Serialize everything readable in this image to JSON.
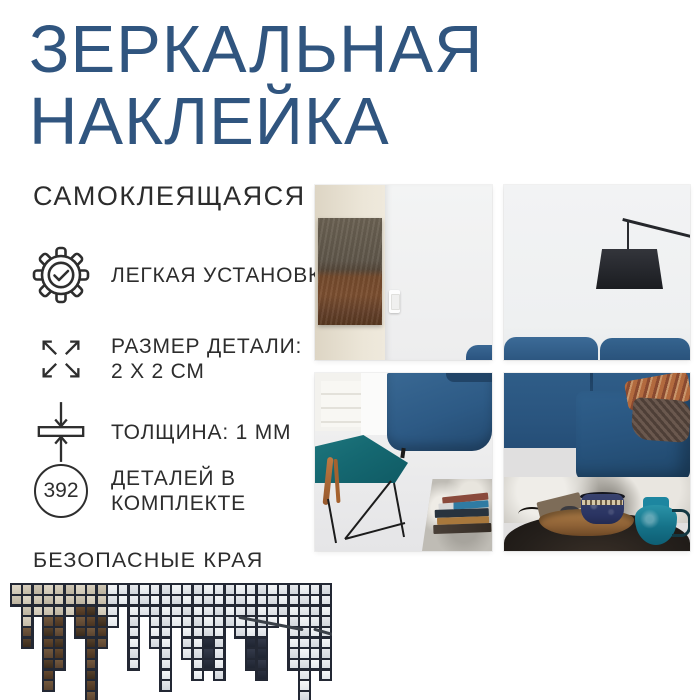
{
  "title": {
    "line1": "ЗЕРКАЛЬНАЯ",
    "line2": "НАКЛЕЙКА",
    "full": "ЗЕРКАЛЬНАЯ\nНАКЛЕЙКА",
    "color": "#30557f"
  },
  "subtitle": "САМОКЛЕЯЩАЯСЯ",
  "features": [
    {
      "icon": "gear-check-icon",
      "label": "ЛЕГКАЯ УСТАНОВКА"
    },
    {
      "icon": "expand-arrows-icon",
      "label": "РАЗМЕР ДЕТАЛИ:\n2 Х 2 СМ"
    },
    {
      "icon": "thickness-icon",
      "label": "ТОЛЩИНА: 1 ММ"
    },
    {
      "icon": "count-badge",
      "badge": "392",
      "label": "ДЕТАЛЕЙ В\nКОМПЛЕКТЕ"
    }
  ],
  "safe_edges_label": "БЕЗОПАСНЫЕ КРАЯ",
  "colors": {
    "background": "#ffffff",
    "title_blue": "#30557f",
    "text_dark": "#2d2d2d",
    "icon_stroke": "#2e2e2e",
    "sofa_blue": "#2e5b86",
    "footstool_teal": "#156871",
    "pitcher_teal": "#157288",
    "artwork_rust": "#744a2c",
    "lamp_black": "#26282e",
    "rug_gray": "#bfbcb5",
    "mosaic_grout": "#232834"
  },
  "mosaic": {
    "pitch": 10.67,
    "grout_w": 2.2,
    "grout": "#232834",
    "palettes": {
      "B": [
        [
          "#ded7c7",
          "#cfc7b5"
        ],
        [
          "#d6cebd",
          "#c6bda9"
        ],
        [
          "#cdc5b4",
          "#bdb4a0"
        ]
      ],
      "L": [
        [
          "#f4f6f8",
          "#e4e8ec"
        ],
        [
          "#eceff2",
          "#dce0e5"
        ],
        [
          "#e4e7eb",
          "#d2d7dd"
        ]
      ],
      "R": [
        [
          "#73593e",
          "#5b4430"
        ],
        [
          "#64492f",
          "#4a3421"
        ],
        [
          "#55402b",
          "#3a2b1c"
        ]
      ],
      "D": [
        [
          "#343a4a",
          "#262c3a"
        ],
        [
          "#2b3140",
          "#1f2532"
        ]
      ]
    },
    "columns": [
      "BB",
      "BBBBRR",
      "BBB",
      "BBBRRRRRRR",
      "BBBRRRRR",
      "BBB",
      "BBRRR",
      "BBRRRRRRRRR",
      "BBBRRR",
      "LLLL",
      "LL",
      "LLLLLLLL",
      "LLL",
      "LLLLLL",
      "LLLLLLLLLL",
      "LLLL",
      "LLLLLLL",
      "LLLLLLLLL",
      "LLLLLDDD",
      "LLLLLLLLL",
      "LLLL",
      "LLLLL",
      "LLLLLDDD",
      "LLLLLDDDD",
      "LLLL",
      "LLL",
      "LLLLLLLL",
      "LLLLLLLLLLL",
      "LLLLLLLL",
      "LLLLLLLLL"
    ]
  }
}
